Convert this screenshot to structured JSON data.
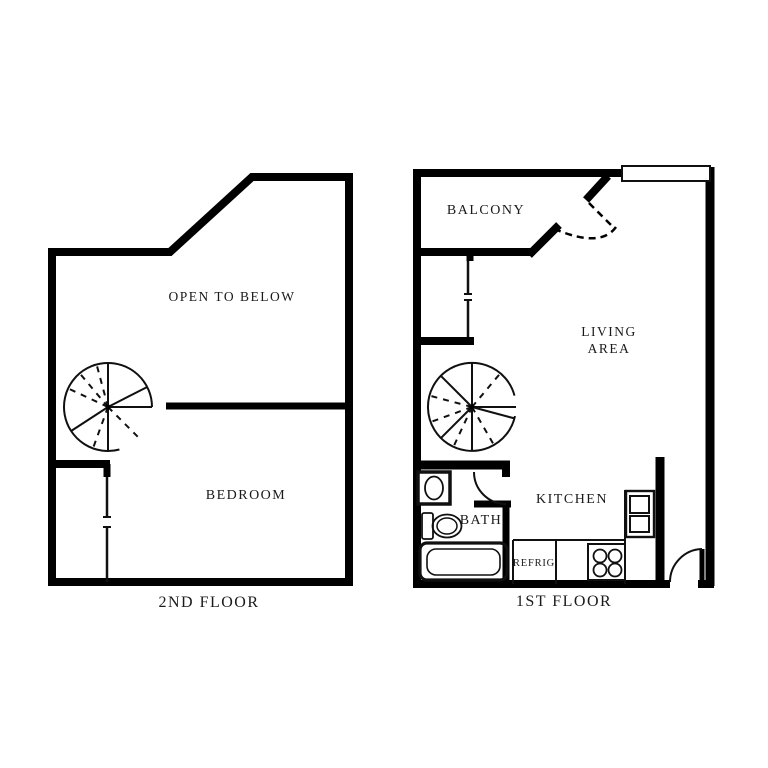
{
  "diagram": {
    "type": "apartment floor plan, two panels",
    "background_color": "#ffffff",
    "wall_color": "#000000",
    "text_color": "#1a1a1a"
  },
  "second_floor": {
    "title": "2ND FLOOR",
    "open_to_below_label": "OPEN TO BELOW",
    "bedroom_label": "BEDROOM",
    "icons": [
      "spiral-staircase-icon",
      "closet-wall"
    ]
  },
  "first_floor": {
    "title": "1ST FLOOR",
    "balcony_label": "BALCONY",
    "living_area_label_line1": "LIVING",
    "living_area_label_line2": "AREA",
    "kitchen_label": "KITCHEN",
    "bath_label": "BATH",
    "refrigerator_label": "REFRIG",
    "icons": [
      "spiral-staircase-icon",
      "sink-icon",
      "toilet-icon",
      "bathtub-icon",
      "stove-icon",
      "oven-cabinet-icon",
      "window-icon",
      "balcony-door-swing-icon",
      "bath-door-swing-icon",
      "entry-door-swing-icon"
    ]
  }
}
